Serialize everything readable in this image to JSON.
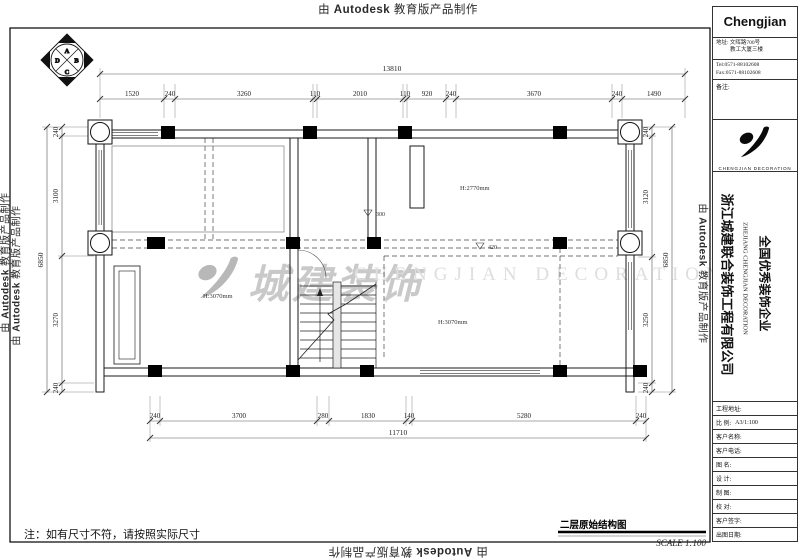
{
  "stamp": {
    "prefix": "由",
    "brand": "Autodesk",
    "suffix": "教育版产品制作"
  },
  "titleblock": {
    "company_short": "Chengjian",
    "address_line1": "地址: 文晖路700号",
    "address_line2": "教工大厦三楼",
    "tel": "Tel:0571-88102608",
    "fax": "Fax:0571-88102608",
    "remark_label": "备注:",
    "logo_caption": "CHENGJIAN DECORATION",
    "company_cn": "浙江城建联合装饰工程有限公司",
    "company_en": "ZHEJIANG CHENGJIAN DECORATION",
    "company_honor": "全国优秀装饰企业",
    "rows": [
      {
        "label": "工程地址:",
        "value": ""
      },
      {
        "label": "比 例:",
        "value": "A3/1:100"
      },
      {
        "label": "客户名称:",
        "value": ""
      },
      {
        "label": "客户电话:",
        "value": ""
      },
      {
        "label": "图 名:",
        "value": ""
      },
      {
        "label": "设 计:",
        "value": ""
      },
      {
        "label": "制 图:",
        "value": ""
      },
      {
        "label": "校 对:",
        "value": ""
      },
      {
        "label": "客户签字:",
        "value": ""
      },
      {
        "label": "出图日期:",
        "value": ""
      }
    ]
  },
  "plan": {
    "compass": {
      "top": "A",
      "right": "B",
      "bottom": "C",
      "left": "D"
    },
    "dims": {
      "top_total": "13810",
      "top": [
        "1520",
        "240",
        "3260",
        "110",
        "2010",
        "110",
        "920",
        "240",
        "3670",
        "240",
        "1490"
      ],
      "bottom": [
        "240",
        "3700",
        "280",
        "1830",
        "140",
        "5280",
        "240"
      ],
      "bottom_total": "11710",
      "left": [
        "240",
        "3100",
        "3270",
        "240"
      ],
      "left_total": "6850",
      "right": [
        "240",
        "3120",
        "3250",
        "240"
      ],
      "right_total": "6850"
    },
    "labels": {
      "ceiling_h_right_top": "H:2770mm",
      "ceiling_h_left": "H:3070mm",
      "ceiling_h_right_bottom": "H:3070mm",
      "level_mid": "300",
      "level_right": "420"
    },
    "watermark": {
      "cn": "城建装饰",
      "en": "CHENGJIAN DECORATION"
    },
    "drawing_title": "二层原始结构图",
    "scale_label": "SCALE 1:100",
    "note": "注：如有尺寸不符，请按照实际尺寸"
  }
}
